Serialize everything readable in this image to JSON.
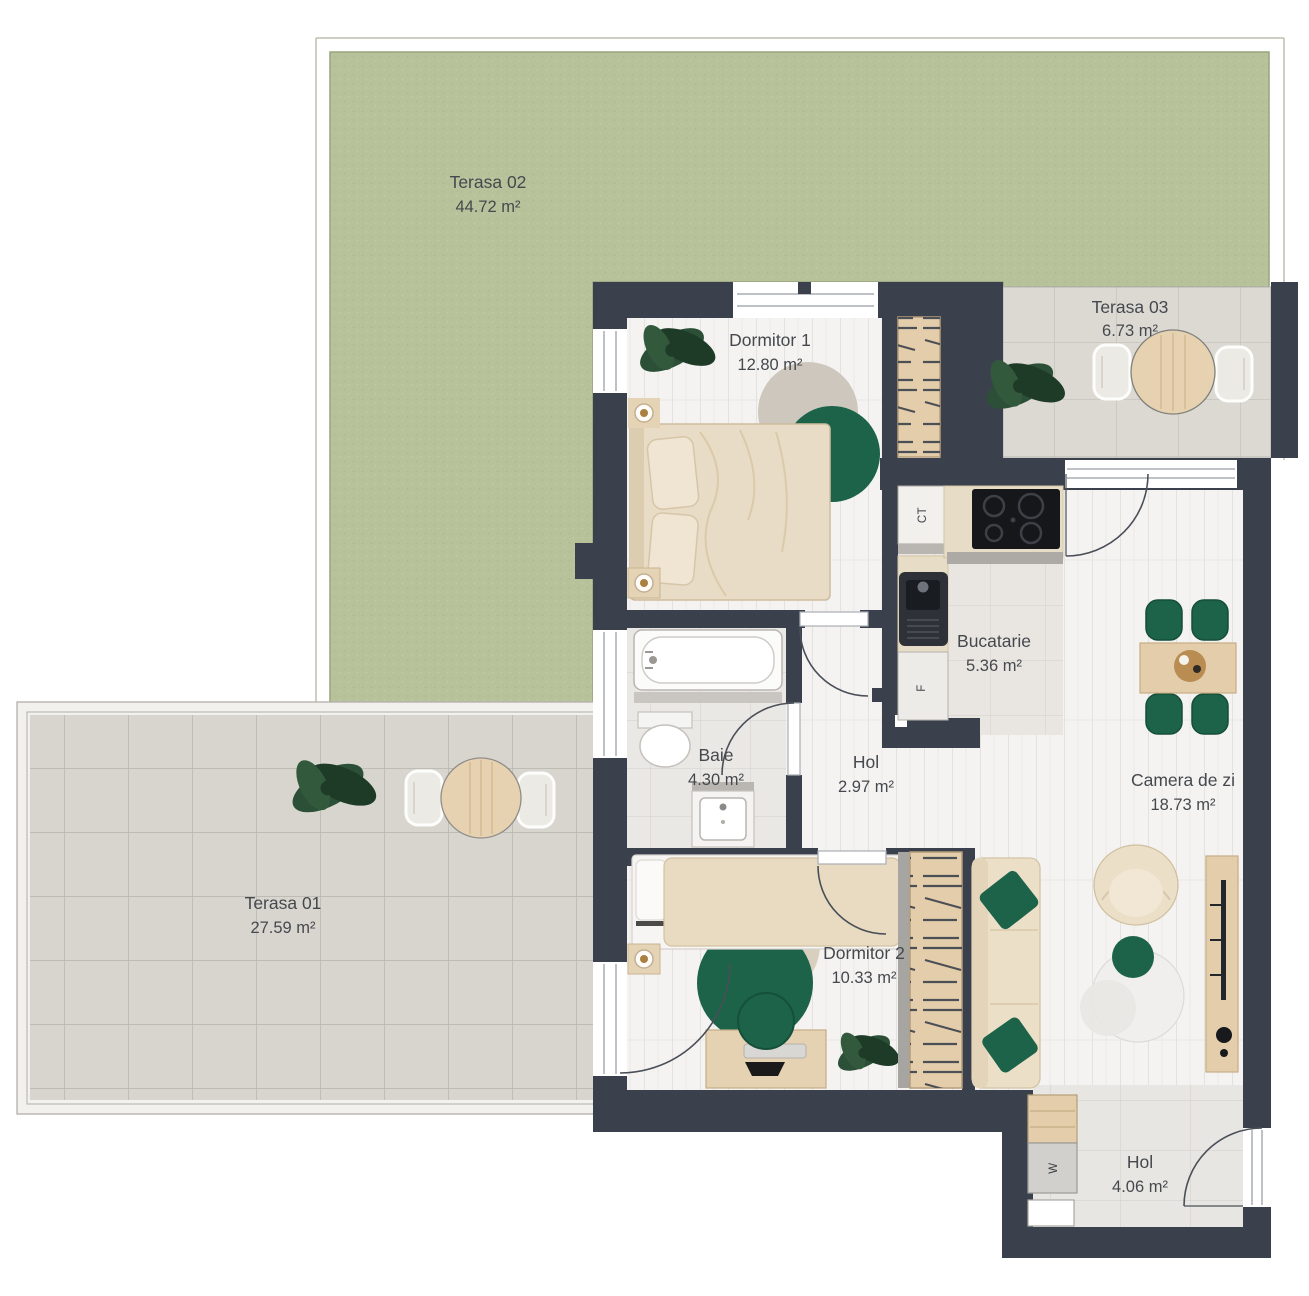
{
  "plan_title": "Apartment floor plan",
  "rooms": [
    {
      "name": "Terasa 02",
      "area": "44.72 m²"
    },
    {
      "name": "Terasa 03",
      "area": "6.73 m²"
    },
    {
      "name": "Terasa 01",
      "area": "27.59 m²"
    },
    {
      "name": "Dormitor 1",
      "area": "12.80 m²"
    },
    {
      "name": "Bucatarie",
      "area": "5.36 m²"
    },
    {
      "name": "Baie",
      "area": "4.30 m²"
    },
    {
      "name": "Hol",
      "area": "2.97 m²"
    },
    {
      "name": "Camera de zi",
      "area": "18.73 m²"
    },
    {
      "name": "Dormitor 2",
      "area": "10.33 m²"
    },
    {
      "name": "Hol",
      "area": "4.06 m²"
    }
  ],
  "appliances": {
    "boiler": "CT",
    "fridge": "F",
    "washer": "W"
  },
  "colors": {
    "wall": "#3a414c",
    "grass": "#b7c29b",
    "terrace_tile": "#d8d5cf",
    "floor_plank": "#f4f3f1",
    "accent_green": "#1d6349",
    "wood": "#e3cdaa",
    "label_text": "#45494e"
  }
}
